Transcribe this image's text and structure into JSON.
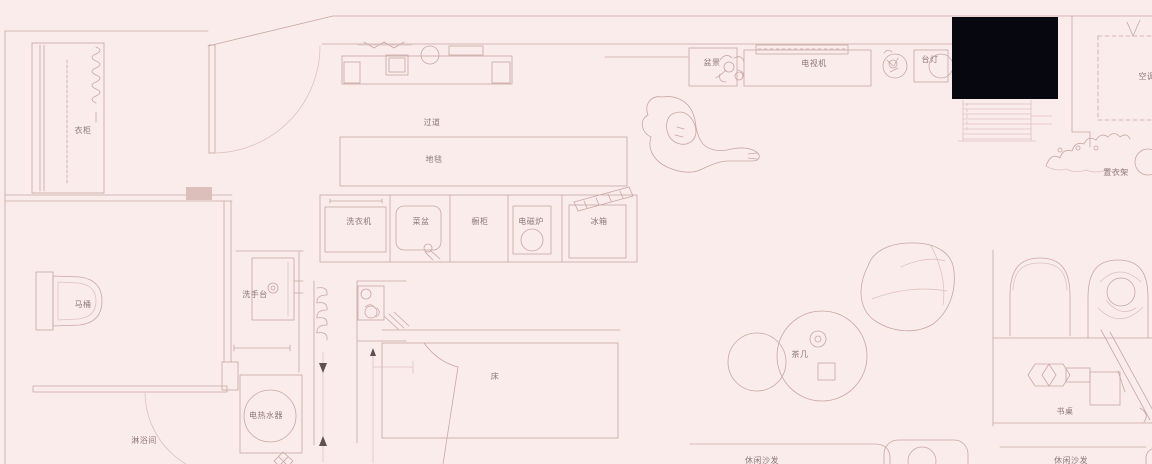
{
  "meta": {
    "drawing_type": "apartment floor plan",
    "style": "CAD line drawing, top view"
  },
  "colors": {
    "background": "#fbecec",
    "line": "#c8a6a2",
    "line_soft": "#dcc2be",
    "text": "#8d7878",
    "arrow": "#5f4f4f",
    "black_area": "#07070f"
  },
  "labels": {
    "wardrobe": "衣柜",
    "corridor": "过道",
    "carpet": "地毯",
    "washing_machine": "洗衣机",
    "vegetable_sink": "菜盆",
    "cupboard": "橱柜",
    "induction_cooker": "电磁炉",
    "fridge": "冰箱",
    "toilet": "马桶",
    "wash_basin": "洗手台",
    "shower_room": "淋浴间",
    "water_heater": "电热水器",
    "bed": "床",
    "tea_table": "茶几",
    "potted_landscape": "盆景",
    "tv": "电视机",
    "table_lamp": "台灯",
    "air_conditioner": "空调",
    "clothes_rack": "置衣架",
    "desk": "书桌",
    "leisure_sofa_left": "休闲沙发",
    "leisure_sofa_right": "休闲沙发"
  }
}
